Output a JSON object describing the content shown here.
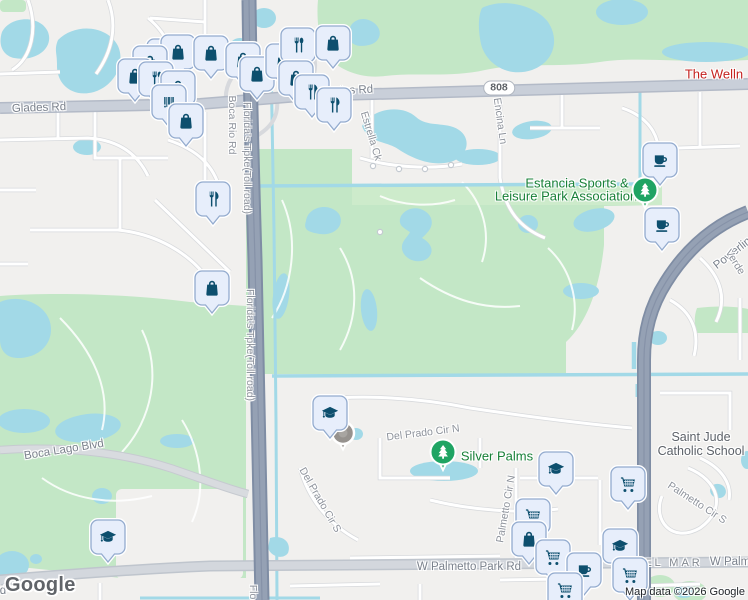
{
  "map": {
    "logo": "Google",
    "attribution": "Map data ©2026 Google",
    "route_shield": {
      "label": "808",
      "x": 499,
      "y": 88
    },
    "colors": {
      "land": "#f1f0ee",
      "water": "#a2d9e7",
      "park_green": "#c3e7c6",
      "park_green_light": "#cdebcb",
      "highway": "#95a1b4",
      "major_road": "#c9cfd9",
      "pin_fill": "#e7eefb",
      "pin_border": "#93abce",
      "pin_icon": "#0d4f6e",
      "park_label": "#188038",
      "poi_red_label": "#c5221f",
      "tree_marker": "#1fa463"
    },
    "labels": [
      {
        "name": "road-label-glades-rd-west",
        "text": "Glades Rd",
        "x": 39,
        "y": 108,
        "rot": -2,
        "cls": "road"
      },
      {
        "name": "road-label-glades-rd-east",
        "text": "Glades Rd",
        "x": 346,
        "y": 91,
        "rot": -3,
        "cls": "road"
      },
      {
        "name": "street-label-estrella-ck",
        "text": "Estrella Ck",
        "x": 371,
        "y": 136,
        "rot": 73,
        "cls": "street"
      },
      {
        "name": "street-label-encina-ln",
        "text": "Encina Ln",
        "x": 500,
        "y": 121,
        "rot": 82,
        "cls": "street"
      },
      {
        "name": "street-label-boca-rio-rd",
        "text": "Boca Rio Rd",
        "x": 232,
        "y": 125,
        "rot": 90,
        "cls": "street"
      },
      {
        "name": "street-label-tpke-north",
        "text": "Florida's Tpke(Toll road)",
        "x": 247,
        "y": 158,
        "rot": 90,
        "cls": "street"
      },
      {
        "name": "street-label-tpke-mid",
        "text": "Florida's Tpke(Toll road)",
        "x": 250,
        "y": 345,
        "rot": 90,
        "cls": "street"
      },
      {
        "name": "street-label-tpke-south",
        "text": "Flo",
        "x": 253,
        "y": 592,
        "rot": 90,
        "cls": "street"
      },
      {
        "name": "road-label-boca-lago-blvd",
        "text": "Boca Lago Blvd",
        "x": 64,
        "y": 450,
        "rot": -9,
        "cls": "road"
      },
      {
        "name": "street-label-del-prado-cir-n",
        "text": "Del Prado Cir N",
        "x": 423,
        "y": 433,
        "rot": -7,
        "cls": "street"
      },
      {
        "name": "street-label-del-prado-cir-s",
        "text": "Del Prado Cir S",
        "x": 320,
        "y": 500,
        "rot": 60,
        "cls": "street"
      },
      {
        "name": "street-label-palmetto-cir-n",
        "text": "Palmetto Cir N",
        "x": 506,
        "y": 509,
        "rot": -80,
        "cls": "street"
      },
      {
        "name": "street-label-palmetto-cir-s",
        "text": "Palmetto Cir S",
        "x": 697,
        "y": 503,
        "rot": 33,
        "cls": "street"
      },
      {
        "name": "road-label-powerline-rd",
        "text": "Powerline Rd",
        "x": 742,
        "y": 246,
        "rot": -38,
        "cls": "road"
      },
      {
        "name": "street-label-verde",
        "text": "Verde",
        "x": 735,
        "y": 262,
        "rot": 58,
        "cls": "street"
      },
      {
        "name": "road-label-w-palmetto-park-rd",
        "text": "W Palmetto Park Rd",
        "x": 469,
        "y": 567,
        "rot": 0,
        "cls": "road"
      },
      {
        "name": "road-label-w-palmetto-park-rd-east",
        "text": "W Palmetto Park Rd",
        "x": 762,
        "y": 562,
        "rot": 0,
        "cls": "road"
      },
      {
        "name": "road-label-fragment-d",
        "text": "d",
        "x": 3,
        "y": 591,
        "rot": 0,
        "cls": "road"
      },
      {
        "name": "poi-label-the-wellness",
        "text": "The Welln",
        "x": 714,
        "y": 74,
        "rot": 0,
        "cls": "poi-red"
      },
      {
        "name": "poi-label-estancia-line1",
        "text": "Estancia Sports &",
        "x": 577,
        "y": 183,
        "rot": 0,
        "cls": "park"
      },
      {
        "name": "poi-label-estancia-line2",
        "text": "Leisure Park Association",
        "x": 566,
        "y": 196,
        "rot": 0,
        "cls": "park"
      },
      {
        "name": "poi-label-silver-palms",
        "text": "Silver Palms",
        "x": 497,
        "y": 456,
        "rot": 0,
        "cls": "park"
      },
      {
        "name": "poi-label-saint-jude-line1",
        "text": "Saint Jude",
        "x": 701,
        "y": 437,
        "rot": 0,
        "cls": "school"
      },
      {
        "name": "poi-label-saint-jude-line2",
        "text": "Catholic School",
        "x": 701,
        "y": 451,
        "rot": 0,
        "cls": "school"
      },
      {
        "name": "neighborhood-label-del-mar",
        "text": "DEL MAR",
        "x": 668,
        "y": 563,
        "rot": 0,
        "cls": "hood"
      }
    ],
    "pins": [
      {
        "x": 164,
        "y": 58,
        "icon": "shopping-bag"
      },
      {
        "x": 178,
        "y": 54,
        "icon": "shopping-bag"
      },
      {
        "x": 150,
        "y": 65,
        "icon": "shopping-bag"
      },
      {
        "x": 211,
        "y": 55,
        "icon": "shopping-bag"
      },
      {
        "x": 135,
        "y": 78,
        "icon": "shopping-bag"
      },
      {
        "x": 156,
        "y": 81,
        "icon": "restaurant-spoon"
      },
      {
        "x": 178,
        "y": 90,
        "icon": "shopping-bag"
      },
      {
        "x": 243,
        "y": 62,
        "icon": "shopping-bag"
      },
      {
        "x": 257,
        "y": 76,
        "icon": "shopping-bag"
      },
      {
        "x": 169,
        "y": 104,
        "icon": "barcode"
      },
      {
        "x": 186,
        "y": 123,
        "icon": "shopping-bag"
      },
      {
        "x": 283,
        "y": 63,
        "icon": "shopping-bag"
      },
      {
        "x": 298,
        "y": 47,
        "icon": "restaurant-spoon"
      },
      {
        "x": 333,
        "y": 45,
        "icon": "shopping-bag"
      },
      {
        "x": 296,
        "y": 80,
        "icon": "shopping-bag"
      },
      {
        "x": 312,
        "y": 94,
        "icon": "restaurant"
      },
      {
        "x": 334,
        "y": 107,
        "icon": "restaurant"
      },
      {
        "x": 213,
        "y": 201,
        "icon": "restaurant"
      },
      {
        "x": 212,
        "y": 290,
        "icon": "shopping-bag"
      },
      {
        "x": 660,
        "y": 162,
        "icon": "coffee"
      },
      {
        "x": 662,
        "y": 227,
        "icon": "coffee"
      },
      {
        "x": 330,
        "y": 415,
        "icon": "graduation-cap"
      },
      {
        "x": 108,
        "y": 539,
        "icon": "graduation-cap"
      },
      {
        "x": 556,
        "y": 471,
        "icon": "graduation-cap"
      },
      {
        "x": 628,
        "y": 486,
        "icon": "shopping-cart"
      },
      {
        "x": 533,
        "y": 518,
        "icon": "shopping-cart"
      },
      {
        "x": 529,
        "y": 541,
        "icon": "shopping-bag"
      },
      {
        "x": 620,
        "y": 548,
        "icon": "graduation-cap"
      },
      {
        "x": 553,
        "y": 559,
        "icon": "shopping-cart"
      },
      {
        "x": 584,
        "y": 572,
        "icon": "coffee"
      },
      {
        "x": 630,
        "y": 577,
        "icon": "shopping-cart"
      },
      {
        "x": 565,
        "y": 592,
        "icon": "shopping-cart"
      }
    ],
    "markers": [
      {
        "type": "park-tree",
        "x": 645,
        "y": 190
      },
      {
        "type": "park-tree",
        "x": 443,
        "y": 452
      },
      {
        "type": "generic-dot",
        "x": 343,
        "y": 433
      }
    ]
  }
}
